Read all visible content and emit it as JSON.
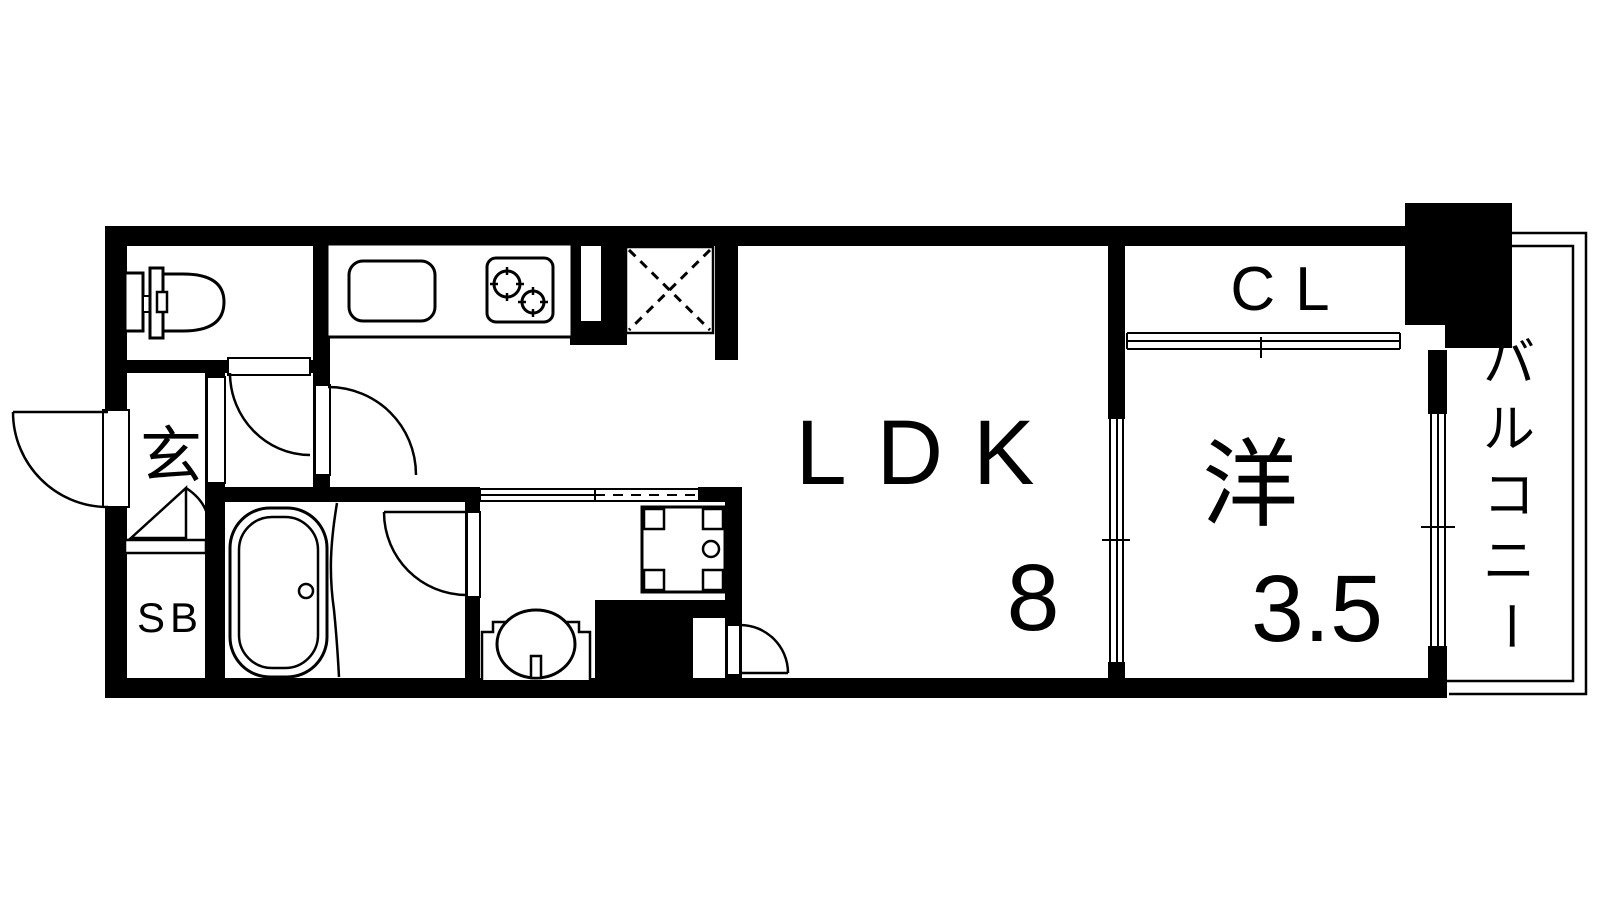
{
  "floor_plan": {
    "kind": "apartment-floorplan-1LDK",
    "labels": {
      "entrance": "玄",
      "shoe_box": "SB",
      "living_dining_kitchen": "LDK",
      "ldk_size": "8",
      "closet": "CL",
      "western_room": "洋",
      "western_room_size": "3.5",
      "balcony": "バルコニー",
      "balcony_chars": [
        "バ",
        "ル",
        "コ",
        "ニ",
        "ー"
      ]
    },
    "fixtures": [
      "toilet",
      "kitchen-sink",
      "gas-stove-2-burner",
      "refrigerator-space",
      "bathtub",
      "washbasin",
      "washing-machine-pan",
      "shoe-box",
      "closet-sliding-door",
      "balcony-window"
    ],
    "colors": {
      "wall": "#000000",
      "floor": "#ffffff",
      "line": "#000000"
    }
  }
}
